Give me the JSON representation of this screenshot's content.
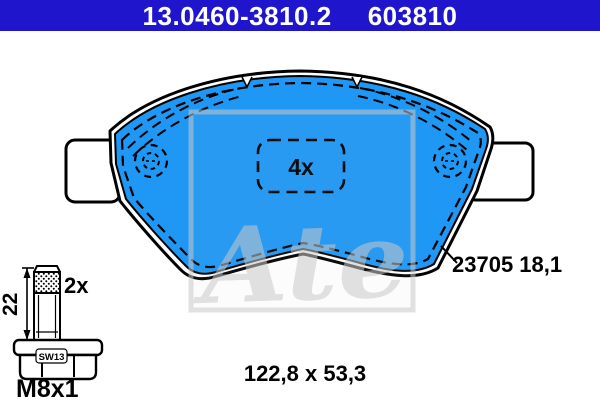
{
  "header": {
    "part_number": "13.0460-3810.2",
    "ref_number": "603810",
    "bg_color": "#1e15cd",
    "text_color": "#ffffff"
  },
  "drawing": {
    "pad": {
      "fill_color": "#1f97f4",
      "quantity_label": "4x",
      "trace_code": "23705 18,1",
      "dimensions_label": "122,8 x 53,3"
    },
    "bolt": {
      "length_label": "22",
      "quantity_label": "2x",
      "wrench_size_label": "SW13",
      "thread_label": "M8x1"
    },
    "watermark_text": "Ate"
  }
}
